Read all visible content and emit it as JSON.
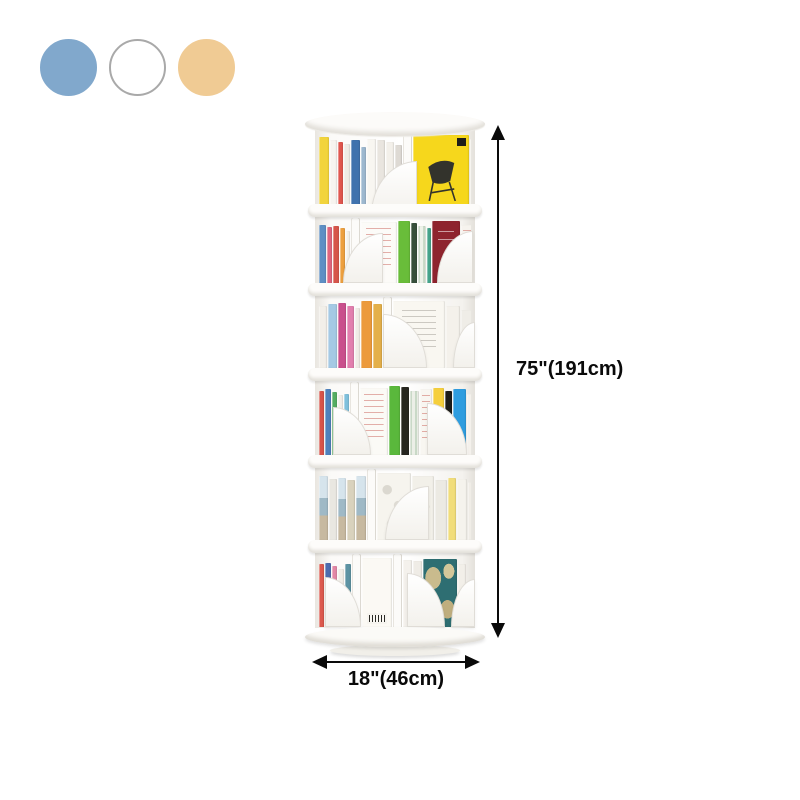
{
  "canvas": {
    "background": "#ffffff"
  },
  "swatches": [
    {
      "id": "blue",
      "color": "#81a8cc",
      "border": "#81a8cc"
    },
    {
      "id": "white",
      "color": "#ffffff",
      "border": "#a9a9a9"
    },
    {
      "id": "tan",
      "color": "#f0cb94",
      "border": "#f0cb94"
    }
  ],
  "annotations": {
    "height_label": "75\"(191cm)",
    "width_label": "18\"(46cm)",
    "arrow_color": "#0a0a0a"
  },
  "product": {
    "subject": "rotating-cylindrical-bookshelf",
    "tier_count": 6,
    "tiers": [
      {
        "books": [
          {
            "c": "#f2d43c",
            "w": 10,
            "h": 92
          },
          {
            "c": "#f7f4ef",
            "w": 7,
            "h": 88
          },
          {
            "c": "#e0564e",
            "w": 5,
            "h": 86
          },
          {
            "c": "#efece6",
            "w": 6,
            "h": 84
          },
          {
            "c": "#3f72ad",
            "w": 9,
            "h": 88
          },
          {
            "c": "#9db8cf",
            "w": 5,
            "h": 80
          },
          {
            "c": "#f8f6f1",
            "w": 9,
            "h": 90
          },
          {
            "c": "#e9e5df",
            "w": 8,
            "h": 88
          },
          {
            "c": "#f3f0ea",
            "w": 8,
            "h": 86
          },
          {
            "c": "#dedad4",
            "w": 7,
            "h": 82
          },
          {
            "c": "#fcfbf9",
            "w": 9,
            "h": 100,
            "t": "pole"
          },
          {
            "c": "#f6d71c",
            "w": 56,
            "h": 94,
            "t": "chair"
          },
          {
            "c": "#f1eee9",
            "w": 6,
            "h": 90
          }
        ],
        "bookends": [
          {
            "x": 56,
            "w": 46,
            "h": 54,
            "d": "l"
          }
        ]
      },
      {
        "books": [
          {
            "c": "#5e8fc4",
            "w": 7,
            "h": 90
          },
          {
            "c": "#e0667e",
            "w": 5,
            "h": 86
          },
          {
            "c": "#d6554a",
            "w": 6,
            "h": 88
          },
          {
            "c": "#eda03f",
            "w": 5,
            "h": 84
          },
          {
            "c": "#f4f1eb",
            "w": 4,
            "h": 80
          },
          {
            "c": "#fcfbf9",
            "w": 9,
            "h": 100,
            "t": "pole"
          },
          {
            "c": "#fcfbf8",
            "w": 36,
            "h": 94,
            "t": "page"
          },
          {
            "c": "#69bd3a",
            "w": 12,
            "h": 96
          },
          {
            "c": "#37503b",
            "w": 6,
            "h": 92
          },
          {
            "c": "#eef2ea",
            "w": 8,
            "h": 88,
            "t": "stripe"
          },
          {
            "c": "#46a48c",
            "w": 4,
            "h": 84
          },
          {
            "c": "#8e242e",
            "w": 28,
            "h": 95,
            "t": "redbook"
          },
          {
            "c": "#f6f3ee",
            "w": 14,
            "h": 90,
            "t": "page"
          }
        ],
        "bookends": [
          {
            "x": 28,
            "w": 40,
            "h": 50,
            "d": "l"
          },
          {
            "x": 122,
            "w": 36,
            "h": 52,
            "d": "l"
          }
        ]
      },
      {
        "books": [
          {
            "c": "#f2efe9",
            "w": 8,
            "h": 88
          },
          {
            "c": "#a5c9e4",
            "w": 9,
            "h": 90
          },
          {
            "c": "#c94f8c",
            "w": 8,
            "h": 92
          },
          {
            "c": "#e27fae",
            "w": 7,
            "h": 88
          },
          {
            "c": "#f0ece6",
            "w": 5,
            "h": 84
          },
          {
            "c": "#ec9a3c",
            "w": 11,
            "h": 94
          },
          {
            "c": "#e4b04a",
            "w": 9,
            "h": 90
          },
          {
            "c": "#fcfbf9",
            "w": 9,
            "h": 100,
            "t": "pole"
          },
          {
            "c": "#f9f7f1",
            "w": 52,
            "h": 95,
            "t": "page2"
          },
          {
            "c": "#f4f1eb",
            "w": 14,
            "h": 88
          },
          {
            "c": "#efede7",
            "w": 12,
            "h": 82
          }
        ],
        "bookends": [
          {
            "x": 68,
            "w": 44,
            "h": 54,
            "d": "r"
          },
          {
            "x": 138,
            "w": 22,
            "h": 46,
            "d": "l"
          }
        ]
      },
      {
        "books": [
          {
            "c": "#d8544a",
            "w": 5,
            "h": 88
          },
          {
            "c": "#4f82bd",
            "w": 6,
            "h": 90
          },
          {
            "c": "#55ad62",
            "w": 5,
            "h": 86
          },
          {
            "c": "#f2efe9",
            "w": 5,
            "h": 82
          },
          {
            "c": "#7fc0dc",
            "w": 5,
            "h": 84
          },
          {
            "c": "#fcfbf9",
            "w": 9,
            "h": 100,
            "t": "pole"
          },
          {
            "c": "#fbfaf6",
            "w": 28,
            "h": 92,
            "t": "page"
          },
          {
            "c": "#5ab83c",
            "w": 11,
            "h": 95
          },
          {
            "c": "#26261f",
            "w": 8,
            "h": 93
          },
          {
            "c": "#ecefe7",
            "w": 9,
            "h": 88,
            "t": "stripe"
          },
          {
            "c": "#f8f6f1",
            "w": 12,
            "h": 90,
            "t": "page"
          },
          {
            "c": "#f5cf3d",
            "w": 11,
            "h": 92
          },
          {
            "c": "#1c1c19",
            "w": 7,
            "h": 88
          },
          {
            "c": "#2f9ddf",
            "w": 13,
            "h": 90
          },
          {
            "c": "#f4f1ec",
            "w": 8,
            "h": 84
          }
        ],
        "bookends": [
          {
            "x": 18,
            "w": 38,
            "h": 48,
            "d": "r"
          },
          {
            "x": 112,
            "w": 40,
            "h": 52,
            "d": "r"
          }
        ]
      },
      {
        "books": [
          {
            "c": "#b9cfdd",
            "w": 9,
            "h": 90,
            "t": "photo"
          },
          {
            "c": "#e9e7e1",
            "w": 8,
            "h": 86
          },
          {
            "c": "#8fb4c4",
            "w": 8,
            "h": 88,
            "t": "photo"
          },
          {
            "c": "#d9d2bd",
            "w": 8,
            "h": 84
          },
          {
            "c": "#a3c3d2",
            "w": 10,
            "h": 90,
            "t": "photo"
          },
          {
            "c": "#fcfbf9",
            "w": 9,
            "h": 100,
            "t": "pole"
          },
          {
            "c": "#f6f4ee",
            "w": 34,
            "h": 94,
            "t": "texture"
          },
          {
            "c": "#f2f0e9",
            "w": 22,
            "h": 90,
            "t": "texture"
          },
          {
            "c": "#eceae3",
            "w": 12,
            "h": 84
          },
          {
            "c": "#f1dd7a",
            "w": 8,
            "h": 88
          },
          {
            "c": "#f5f3ed",
            "w": 10,
            "h": 86
          },
          {
            "c": "#f0ede7",
            "w": 8,
            "h": 82
          }
        ],
        "bookends": [
          {
            "x": 70,
            "w": 44,
            "h": 54,
            "d": "l"
          }
        ]
      },
      {
        "books": [
          {
            "c": "#dd5a4f",
            "w": 5,
            "h": 86
          },
          {
            "c": "#4d6cae",
            "w": 6,
            "h": 88
          },
          {
            "c": "#e287a6",
            "w": 5,
            "h": 84
          },
          {
            "c": "#f1eee8",
            "w": 6,
            "h": 80
          },
          {
            "c": "#5d93a3",
            "w": 6,
            "h": 86
          },
          {
            "c": "#fcfbf9",
            "w": 9,
            "h": 100,
            "t": "pole"
          },
          {
            "c": "#fbf9f4",
            "w": 30,
            "h": 94,
            "t": "barcode"
          },
          {
            "c": "#fcfbf9",
            "w": 9,
            "h": 100,
            "t": "pole"
          },
          {
            "c": "#f4f1ec",
            "w": 9,
            "h": 92
          },
          {
            "c": "#efece6",
            "w": 9,
            "h": 90
          },
          {
            "c": "#2e6e72",
            "w": 34,
            "h": 93,
            "t": "map"
          },
          {
            "c": "#f2efe9",
            "w": 8,
            "h": 86
          }
        ],
        "bookends": [
          {
            "x": 10,
            "w": 36,
            "h": 50,
            "d": "r"
          },
          {
            "x": 92,
            "w": 38,
            "h": 54,
            "d": "r"
          },
          {
            "x": 136,
            "w": 24,
            "h": 48,
            "d": "l"
          }
        ]
      }
    ]
  }
}
